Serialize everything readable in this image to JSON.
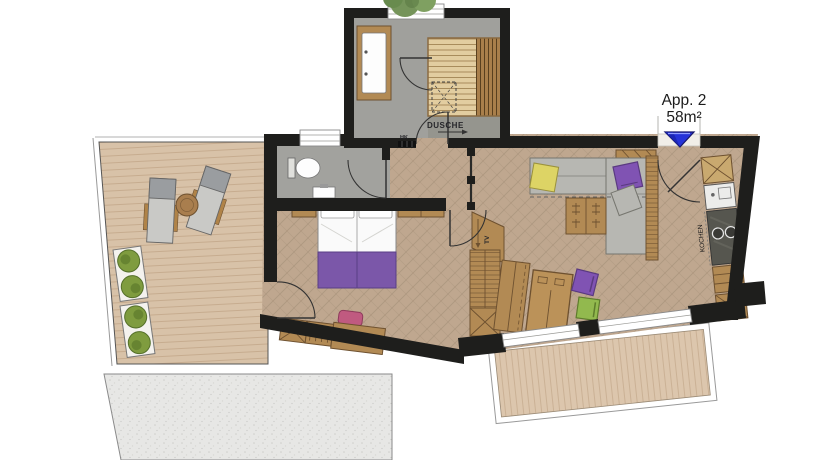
{
  "labels": {
    "apartment_name": "App. 2",
    "apartment_area": "58m²",
    "shower": "DUSCHE",
    "radiator": "HK",
    "kitchen": "KOCHEN",
    "tv_sideboard": "TV",
    "tv_panel": "TV"
  },
  "colors": {
    "wall": "#1e1e1c",
    "floor-wood": "#bfa78f",
    "floor-wood-line": "#a08a74",
    "terrace-deck": "#d8c2a8",
    "terrace-line": "#b0906f",
    "lower-deck": "#dcc6ad",
    "bath-floor": "#a0a09c",
    "wc-floor": "#a2a29e",
    "shower-floor": "#95958e",
    "sauna-wood": "#e2cda0",
    "sauna-slats": "#a97f4b",
    "furniture-wood": "#b28a54",
    "furniture-wood-dark": "#6e5130",
    "sofa-gray": "#b7b7b2",
    "bed-purple": "#7b57a9",
    "pillow-yellow": "#ddd465",
    "chair-purple": "#8053b3",
    "chair-green": "#92b94e",
    "stool-pink": "#c05a80",
    "plant-green": "#7f9c3f",
    "plant-green-dark": "#5d7a2c",
    "gravel": "#e7e7e5",
    "marker-blue": "#2633d8"
  }
}
